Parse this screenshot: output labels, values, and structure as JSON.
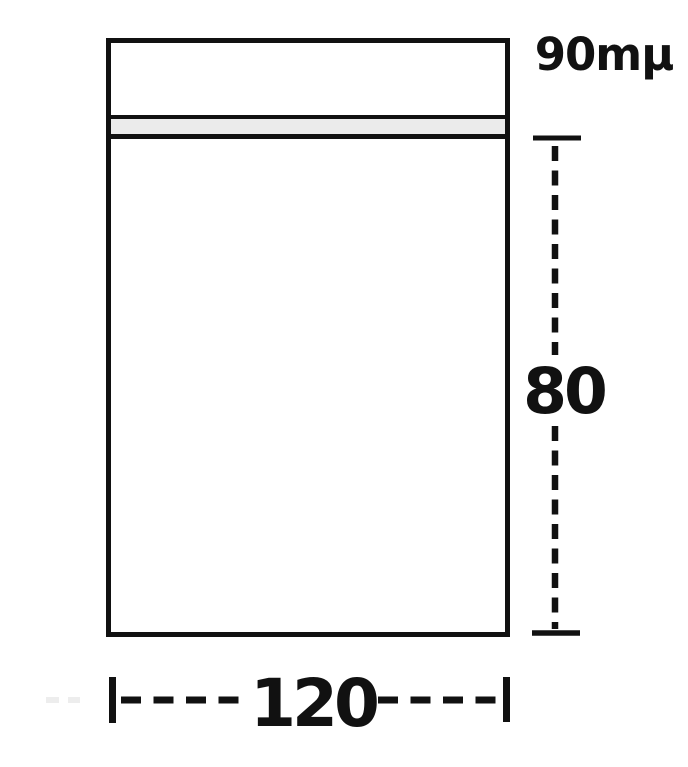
{
  "diagram": {
    "labels": {
      "thickness": "90mµ",
      "height": "80",
      "width": "120"
    },
    "colors": {
      "line": "#111111",
      "seal_fill": "#ebebeb",
      "background": "#ffffff",
      "faint_mark": "#ededed"
    }
  }
}
